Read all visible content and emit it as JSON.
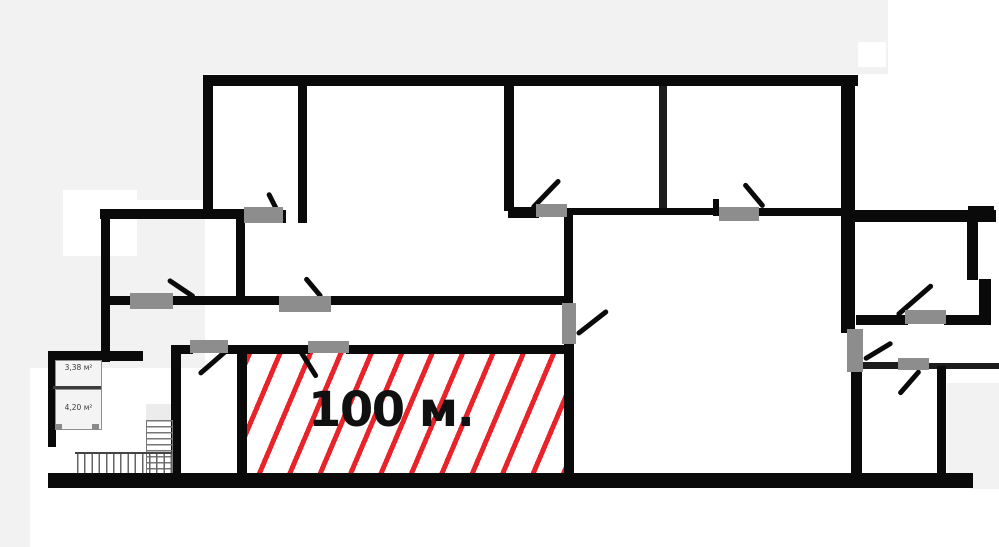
{
  "plan": {
    "highlighted_area": {
      "label": "100 м."
    },
    "small_rooms": [
      {
        "area_label": "3,38 м²"
      },
      {
        "area_label": "4,20 м²"
      }
    ],
    "colors": {
      "wall": "#0a0a0a",
      "door_marker": "#8d8d8d",
      "hatch_red": "#e8232a",
      "outside_gray": "#f2f2f3",
      "small_room_fill": "#f4f4f4",
      "area_label_text": "#101010",
      "small_label_text": "#3a3a3a"
    }
  }
}
